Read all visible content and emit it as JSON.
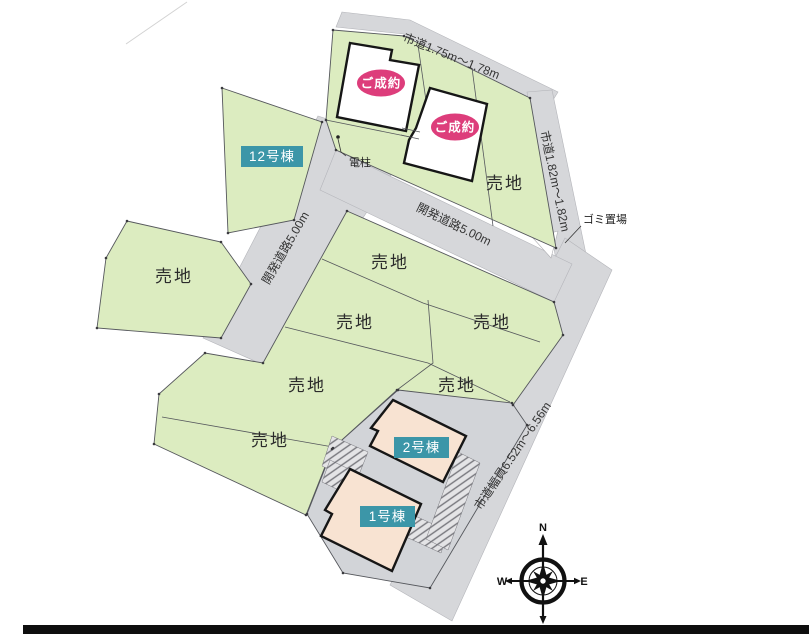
{
  "plan": {
    "lot_label": "売地",
    "sold_label": "ご成約",
    "building_12": "12号棟",
    "building_2": "2号棟",
    "building_1": "1号棟",
    "road_top": "市道1.75m〜1.78m",
    "road_right": "市道1.82m〜1.82m",
    "road_wide": "市道幅員6.52m〜6.56m",
    "road_dev": "開発道路5.00m",
    "pole": "電柱",
    "garbage": "ゴミ置場",
    "compass": {
      "n": "N",
      "e": "E",
      "s": "S",
      "w": "W"
    },
    "colors": {
      "lot_green": "#dcecc0",
      "road_gray": "#d6d7da",
      "building_lot_gray": "#d2d4d8",
      "sold_pink": "#dd3d7b",
      "label_teal": "#3c96a8",
      "house_beige": "#f8e3d2"
    }
  }
}
